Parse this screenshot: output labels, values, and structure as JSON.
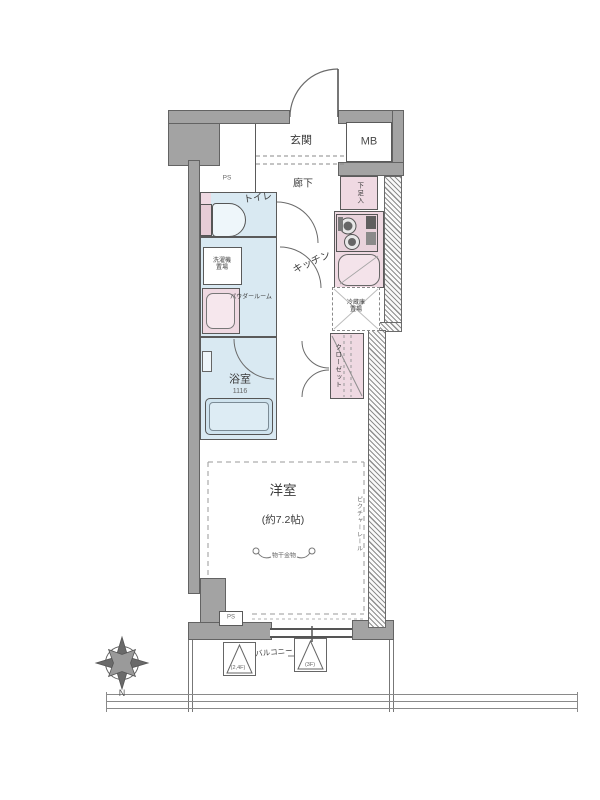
{
  "floor_plan": {
    "entrance": {
      "label": "玄関"
    },
    "meter_box": {
      "label": "MB"
    },
    "pipe_space_top": {
      "label": "PS"
    },
    "hallway": {
      "label": "廊下"
    },
    "toilet": {
      "label": "トイレ"
    },
    "shoe_storage": {
      "label": "下足入"
    },
    "kitchen": {
      "label": "キッチン"
    },
    "washer_space": {
      "line1": "洗濯機",
      "line2": "置場"
    },
    "powder_room": {
      "label": "パウダールーム"
    },
    "fridge_space": {
      "line1": "冷蔵庫",
      "line2": "置場"
    },
    "closet": {
      "label": "クローゼット"
    },
    "bathroom": {
      "label": "浴室",
      "size": "1116"
    },
    "main_room": {
      "label": "洋室",
      "size": "(約7.2帖)"
    },
    "laundry_hook": {
      "label": "物干金物"
    },
    "picture_rail": {
      "label": "ピクチャーレール"
    },
    "pipe_space_bottom": {
      "label": "PS"
    },
    "balcony": {
      "label": "バルコニー",
      "hatch_left": "(2,4F)",
      "hatch_right": "(3F)"
    },
    "compass": {
      "north": "N"
    }
  },
  "colors": {
    "wall": "#a3a3a3",
    "wet_area_fill": "#d9e9f2",
    "fixture_fill": "#efd9e2",
    "line": "#5a5a5a"
  }
}
